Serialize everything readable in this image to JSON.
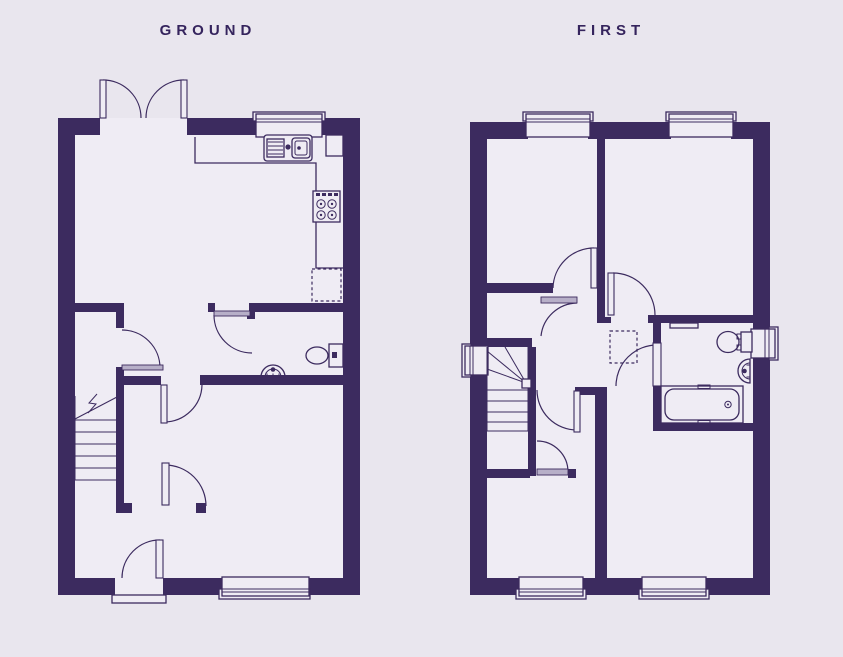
{
  "colors": {
    "bg": "#e9e6ee",
    "floor": "#efecf4",
    "wall": "#3c2b5f",
    "leaf": "#b7afc8",
    "title": "#35245d"
  },
  "plans": {
    "ground": {
      "label": "GROUND",
      "fixtures": [
        "french-doors",
        "kitchen-window",
        "kitchen-counter",
        "kitchen-sink",
        "hob",
        "appliance-space",
        "wc-toilet",
        "wc-basin",
        "staircase",
        "entrance-door",
        "living-room-window"
      ]
    },
    "first": {
      "label": "FIRST",
      "fixtures": [
        "bedroom-windows",
        "landing",
        "loft-hatch",
        "staircase",
        "bathroom-bath",
        "bathroom-toilet",
        "bathroom-basin",
        "towel-shelf",
        "bathroom-window",
        "stair-window"
      ]
    }
  }
}
